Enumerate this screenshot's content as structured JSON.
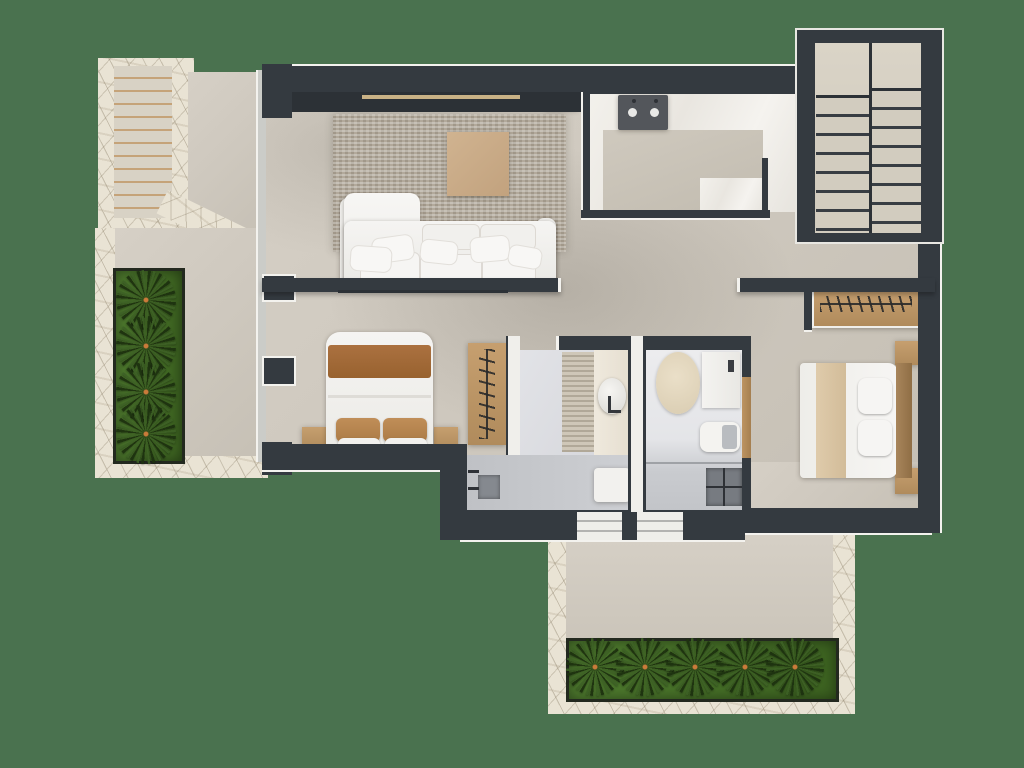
{
  "title": "Upper-floor 3D floor plan, top-down render",
  "palette": {
    "bg": "#4A724F",
    "wall": "#343A40",
    "walldeep": "#2C3136",
    "trim": "#F3F2EE",
    "floor": "#D0CAC0",
    "marble": "#EFEDE8",
    "bathfloor": "#DDDEE2",
    "showerfloor": "#C7C9CD",
    "stone": "#E9E3D4",
    "rug": "#B2A99B",
    "wood": "#BE9968",
    "wooddark": "#9A7850",
    "plant": "#4E7D31",
    "plantdark": "#2E4C1D",
    "white": "#F4F3F0",
    "blanket": "#A56D3B",
    "runnertan": "#D9C5A5",
    "ottoman": "#C9AC8A",
    "cooktop": "#53565B",
    "beamlight": "#C9B286",
    "glass": "#CBCCC8"
  },
  "rooms": [
    {
      "name": "Living room",
      "furniture": [
        "corner sofa with cushions",
        "woven area rug",
        "beige ottoman",
        "media console",
        "ceiling beam with light strip"
      ]
    },
    {
      "name": "Kitchen",
      "furniture": [
        "island counter",
        "cooktop with two burners"
      ]
    },
    {
      "name": "Bedroom left",
      "furniture": [
        "double bed with brown throw",
        "two brown pillows",
        "two wood nightstands",
        "open wardrobe with hangers"
      ]
    },
    {
      "name": "Bedroom right",
      "furniture": [
        "double bed with tan runner",
        "wood headboard",
        "two wood nightstands",
        "open wardrobe with hanger rail",
        "wood door to en-suite"
      ]
    },
    {
      "name": "Bathroom center",
      "furniture": [
        "vanity with oval vessel sink",
        "textured runner rug",
        "shower bench"
      ]
    },
    {
      "name": "Shower room",
      "furniture": [
        "dark shower tray",
        "wall shower arms",
        "white bench"
      ]
    },
    {
      "name": "En-suite bathroom",
      "furniture": [
        "oval bath mat",
        "vanity counter",
        "toilet",
        "walk-in shower with glass screen"
      ]
    },
    {
      "name": "Hallway",
      "furniture": []
    }
  ],
  "outdoor": {
    "entry_stairs_top_left": {
      "steps": 12,
      "material": "concrete with tan nosing",
      "surround": "stone pathway"
    },
    "left_courtyard": {
      "planter_palms": 4,
      "surface": "concrete terrace with stone border"
    },
    "interior_stairs_top_right": {
      "flights": 2,
      "steps_per_flight": 8,
      "landing": true
    },
    "back_terrace": {
      "planter_palms": 5,
      "surface": "concrete terrace with stone pathway",
      "glass_doors": 2
    }
  },
  "notes": "Static architectural render; no text, controls or interactive elements visible."
}
